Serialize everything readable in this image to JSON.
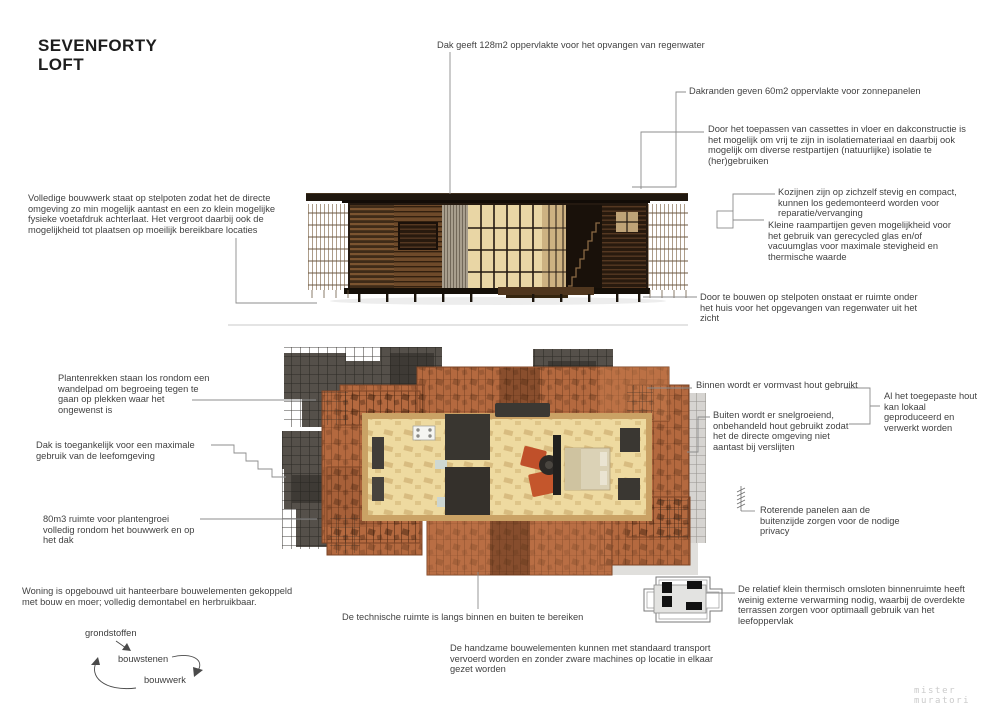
{
  "title": {
    "line1": "SEVENFORTY",
    "line2": "LOFT"
  },
  "annotations": {
    "roof_rainwater": "Dak geeft 128m2 oppervlakte voor het opvangen van regenwater",
    "solar_edges": "Dakranden geven 60m2 oppervlakte voor zonnepanelen",
    "cassettes": "Door het toepassen van cassettes in vloer en dakconstructie is het mogelijk om vrij te zijn in isolatiemateriaal en daarbij ook mogelijk om diverse restpartijen (natuurlijke) isolatie te (her)gebruiken",
    "frames": "Kozijnen zijn op zichzelf stevig en compact, kunnen los gedemonteerd worden voor reparatie/vervanging",
    "small_windows": "Kleine raampartijen geven mogelijkheid voor het gebruik van gerecycled glas en/of vacuumglas voor maximale stevigheid en thermische waarde",
    "stilts_footprint": "Volledige bouwwerk staat op stelpoten zodat het de directe omgeving zo min mogelijk aantast en een zo klein mogelijke fysieke voetafdruk achterlaat. Het vergroot daarbij ook de mogelijkheid tot plaatsen op moeilijk bereikbare locaties",
    "stilts_rainwater": "Door te bouwen op stelpoten onstaat er ruimte onder het huis voor het opgevangen van regenwater uit het zicht",
    "plant_racks": "Plantenrekken staan los rondom een wandelpad om begroeing tegen te gaan op plekken waar het ongewenst is",
    "interior_wood": "Binnen wordt er vormvast hout gebruikt",
    "exterior_wood": "Buiten wordt er snelgroeiend, onbehandeld hout gebruikt zodat het de directe omgeving niet aantast bij verslijten",
    "local_wood": "Al het toegepaste hout kan lokaal geproduceerd en verwerkt worden",
    "roof_access": "Dak is toegankelijk voor een maximale gebruik van de leefomgeving",
    "plant_volume": "80m3 ruimte voor plantengroei volledig rondom het bouwwerk en op het dak",
    "rotating_panels": "Roterende panelen aan de buitenzijde zorgen voor de nodige privacy",
    "demountable": "Woning is opgebouwd uit hanteerbare bouwelementen gekoppeld met bouw en moer; volledig demontabel en herbruikbaar.",
    "technical_room": "De technische ruimte is langs binnen en buiten te bereiken",
    "thermal": "De relatief klein thermisch omsloten binnenruimte heeft weinig externe verwarming nodig, waarbij de overdekte terrassen zorgen voor optimaall gebruik van het leefoppervlak",
    "transport": "De handzame bouwelementen kunnen met standaard transport vervoerd worden en zonder zware machines op locatie in elkaar gezet worden"
  },
  "cycle": {
    "node1": "grondstoffen",
    "node2": "bouwstenen",
    "node3": "bouwwerk"
  },
  "watermark": "mister muratori",
  "icons": {
    "window_square": "window-frame-icon",
    "rotating_panels": "hinged-panel-strip-icon",
    "floorplan": "thermal-floorplan-icon",
    "cycle_arrows": "cycle-arrows"
  },
  "colors": {
    "background": "#ffffff",
    "annotation_text": "#424242",
    "title_text": "#1d1d1d",
    "leader_line": "#8c8c8c",
    "watermark": "#cbcbcb",
    "dark_wood": "#241910",
    "mid_wood": "#6e4a2a",
    "warm_glow": "#e9d6a5",
    "terracotta_deck": "#b4693f",
    "interior_floor": "#eedaa0",
    "accent_chair": "#c0502a",
    "cast_shadow": "#55504a"
  }
}
